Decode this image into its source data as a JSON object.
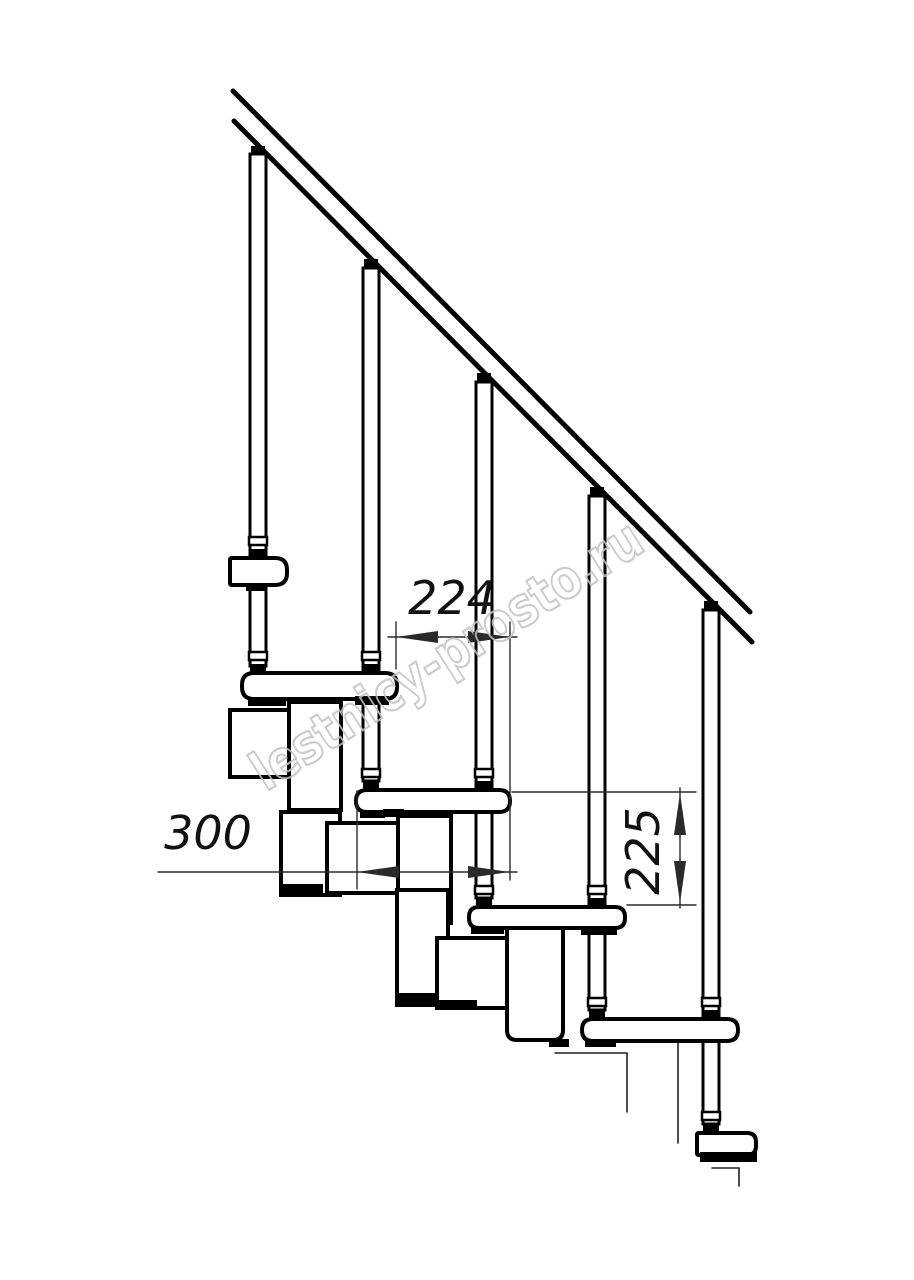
{
  "meta": {
    "title": "Modular staircase side elevation drawing",
    "drawing_type": "technical line drawing"
  },
  "canvas": {
    "width": 914,
    "height": 1280,
    "background": "#ffffff"
  },
  "colors": {
    "line": "#000000",
    "dimension_line": "#2a2a2a",
    "dimension_text": "#111111",
    "watermark": "#c3c3c3"
  },
  "watermark": {
    "text": "lestnicy-prosto.ru",
    "angle": -32.5,
    "x": 266,
    "y": 792,
    "font_size": 54,
    "length": 452
  },
  "dimensions": [
    {
      "id": "going",
      "label": "224",
      "orientation": "horizontal",
      "line": [
        388,
        637,
        517,
        637
      ],
      "arrows": [
        {
          "tip": [
            396,
            637
          ],
          "dir": "left"
        },
        {
          "tip": [
            510,
            637
          ],
          "dir": "right"
        }
      ],
      "ext_lines": [
        [
          396,
          622,
          396,
          669
        ],
        [
          510,
          622,
          510,
          880
        ]
      ],
      "text_x": 452,
      "text_y": 614,
      "rotate": 0
    },
    {
      "id": "tread-depth",
      "label": "300",
      "orientation": "horizontal",
      "line": [
        158,
        872,
        517,
        872
      ],
      "arrows": [
        {
          "tip": [
            357,
            872
          ],
          "dir": "left"
        },
        {
          "tip": [
            510,
            872
          ],
          "dir": "right"
        }
      ],
      "ext_lines": [
        [
          357,
          791,
          357,
          889
        ]
      ],
      "text_x": 208,
      "text_y": 849,
      "rotate": 0
    },
    {
      "id": "rise",
      "label": "225",
      "orientation": "vertical",
      "line": [
        680,
        788,
        680,
        908
      ],
      "arrows": [
        {
          "tip": [
            680,
            793
          ],
          "dir": "up"
        },
        {
          "tip": [
            680,
            903
          ],
          "dir": "down"
        }
      ],
      "ext_lines": [
        [
          512,
          792,
          696,
          792
        ],
        [
          627,
          905,
          696,
          905
        ]
      ],
      "text_x": 659,
      "text_y": 851,
      "rotate": -90
    }
  ],
  "drawing": {
    "rail": {
      "stroke_width": 5,
      "lines": [
        [
          233,
          91,
          750,
          612
        ],
        [
          234,
          121,
          752,
          642
        ]
      ]
    },
    "balusters": {
      "width": 16,
      "stroke_width": 3,
      "items": [
        {
          "x": 250,
          "top": 154,
          "bottom": 666
        },
        {
          "x": 363,
          "top": 268,
          "bottom": 781
        },
        {
          "x": 476,
          "top": 382,
          "bottom": 898
        },
        {
          "x": 589,
          "top": 496,
          "bottom": 1010
        },
        {
          "x": 703,
          "top": 610,
          "bottom": 1124
        }
      ]
    },
    "treads": {
      "stroke_width": 4,
      "items": [
        {
          "x": 230,
          "y": 558,
          "w": 57,
          "h": 27,
          "rl": 2,
          "rr": 12
        },
        {
          "x": 242,
          "y": 673,
          "w": 155,
          "h": 26,
          "rl": 12,
          "rr": 12
        },
        {
          "x": 356,
          "y": 790,
          "w": 154,
          "h": 22,
          "rl": 11,
          "rr": 11
        },
        {
          "x": 469,
          "y": 907,
          "w": 156,
          "h": 21,
          "rl": 10,
          "rr": 10
        },
        {
          "x": 582,
          "y": 1019,
          "w": 156,
          "h": 22,
          "rl": 11,
          "rr": 11
        },
        {
          "x": 697,
          "y": 1133,
          "w": 59,
          "h": 22,
          "rl": 2,
          "rr": 9
        }
      ]
    },
    "modules": {
      "stroke_width": 4,
      "boxes": [
        {
          "x": 230,
          "y": 710,
          "w": 60,
          "h": 67,
          "rb": 0
        },
        {
          "x": 289,
          "y": 702,
          "w": 52,
          "h": 108,
          "rb": 0
        },
        {
          "x": 281,
          "y": 812,
          "w": 59,
          "h": 83,
          "rb": 0
        },
        {
          "x": 327,
          "y": 823,
          "w": 77,
          "h": 70,
          "rb": 0
        },
        {
          "x": 398,
          "y": 816,
          "w": 53,
          "h": 107,
          "rb": 0
        },
        {
          "x": 397,
          "y": 890,
          "w": 51,
          "h": 115,
          "rb": 0
        },
        {
          "x": 437,
          "y": 938,
          "w": 80,
          "h": 70,
          "rb": 0
        },
        {
          "x": 507,
          "y": 927,
          "w": 56,
          "h": 113,
          "rb": 10
        }
      ]
    },
    "rail_wedges": [
      {
        "x": 251,
        "y": 146
      },
      {
        "x": 364,
        "y": 259
      },
      {
        "x": 477,
        "y": 373
      },
      {
        "x": 590,
        "y": 487
      },
      {
        "x": 704,
        "y": 601
      }
    ],
    "tread_joints": [
      {
        "cx": 258,
        "ty": 558
      },
      {
        "cx": 258,
        "ty": 673
      },
      {
        "cx": 371,
        "ty": 673
      },
      {
        "cx": 371,
        "ty": 790
      },
      {
        "cx": 484,
        "ty": 790
      },
      {
        "cx": 484,
        "ty": 907
      },
      {
        "cx": 597,
        "ty": 907
      },
      {
        "cx": 597,
        "ty": 1019
      },
      {
        "cx": 711,
        "ty": 1019
      },
      {
        "cx": 711,
        "ty": 1133
      }
    ],
    "black_flanges": [
      [
        246,
        584,
        20,
        7
      ],
      [
        248,
        698,
        38,
        8
      ],
      [
        355,
        696,
        34,
        9
      ],
      [
        360,
        811,
        25,
        7
      ],
      [
        383,
        809,
        21,
        8
      ],
      [
        471,
        927,
        33,
        7
      ],
      [
        581,
        926,
        36,
        9
      ],
      [
        585,
        1040,
        31,
        7
      ],
      [
        700,
        1152,
        57,
        10
      ],
      [
        281,
        884,
        42,
        11
      ],
      [
        397,
        993,
        40,
        11
      ],
      [
        437,
        1000,
        40,
        9
      ],
      [
        549,
        1039,
        20,
        8
      ]
    ],
    "thin_lines": [
      [
        555,
        1053,
        627,
        1053
      ],
      [
        627,
        1053,
        627,
        1112
      ],
      [
        678,
        1043,
        678,
        1143
      ],
      [
        712,
        1168,
        739,
        1168
      ],
      [
        739,
        1168,
        739,
        1186
      ]
    ],
    "arrow": {
      "length": 42,
      "half_width": 6
    }
  }
}
